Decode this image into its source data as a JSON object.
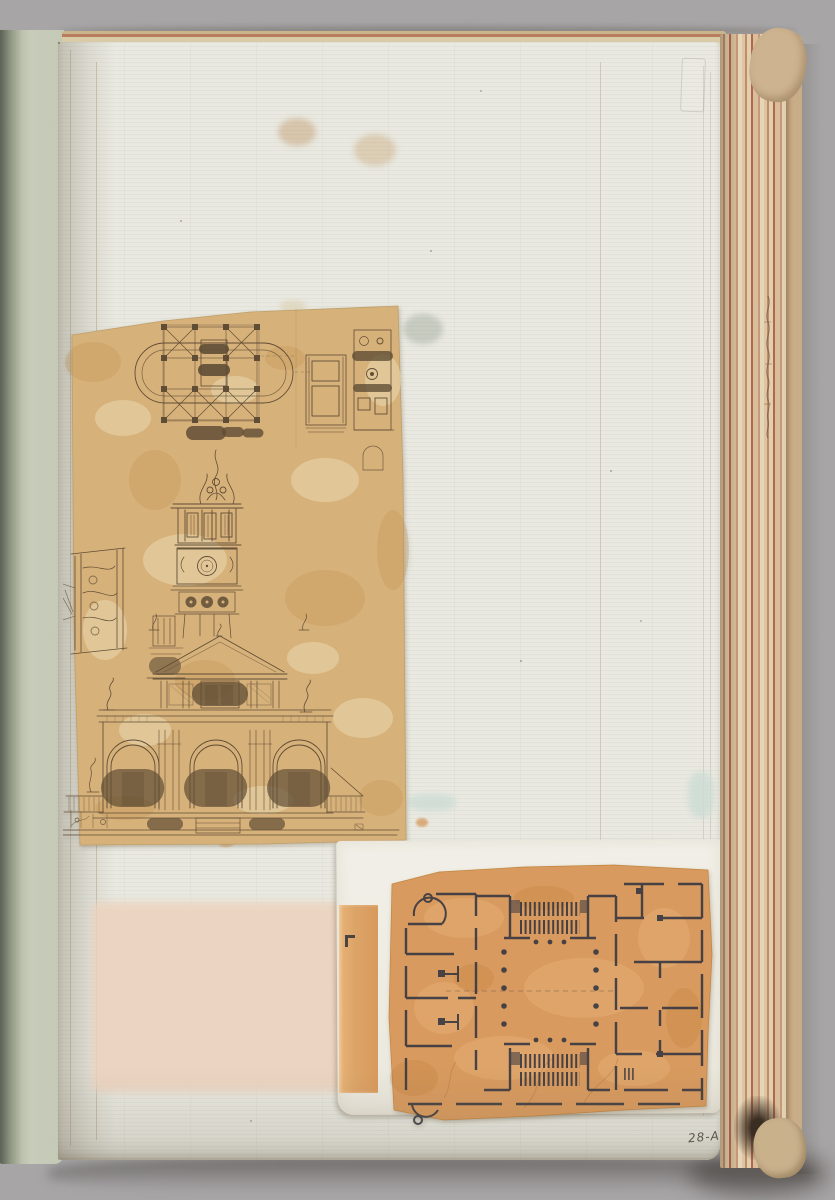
{
  "scene": {
    "kind": "photograph of an open album page with pasted architectural drawings",
    "backdrop_color": "#a7a5a6"
  },
  "book": {
    "cover_color": "#c6cab8",
    "page_color": "#e9e9e1",
    "fore_edge_colors": [
      "#e0d0ae",
      "#d8bf9b",
      "#c38b6b",
      "#b3654d"
    ],
    "spine_edge_color": "#c9ad88",
    "page_label": "28-A"
  },
  "pasted_items": {
    "plan_elevation_sheet": {
      "paper_color": "#d7b17a",
      "ink_color": "#5a4832"
    },
    "backing_sheet": {
      "paper_color": "#efede5"
    },
    "orange_strip": {
      "paper_color": "#dfa96d"
    },
    "floor_plan_sheet": {
      "paper_color": "#d89a5e",
      "ink_color": "#3b3a42"
    },
    "offset_patch": {
      "paper_color": "#ecd3bf"
    }
  }
}
